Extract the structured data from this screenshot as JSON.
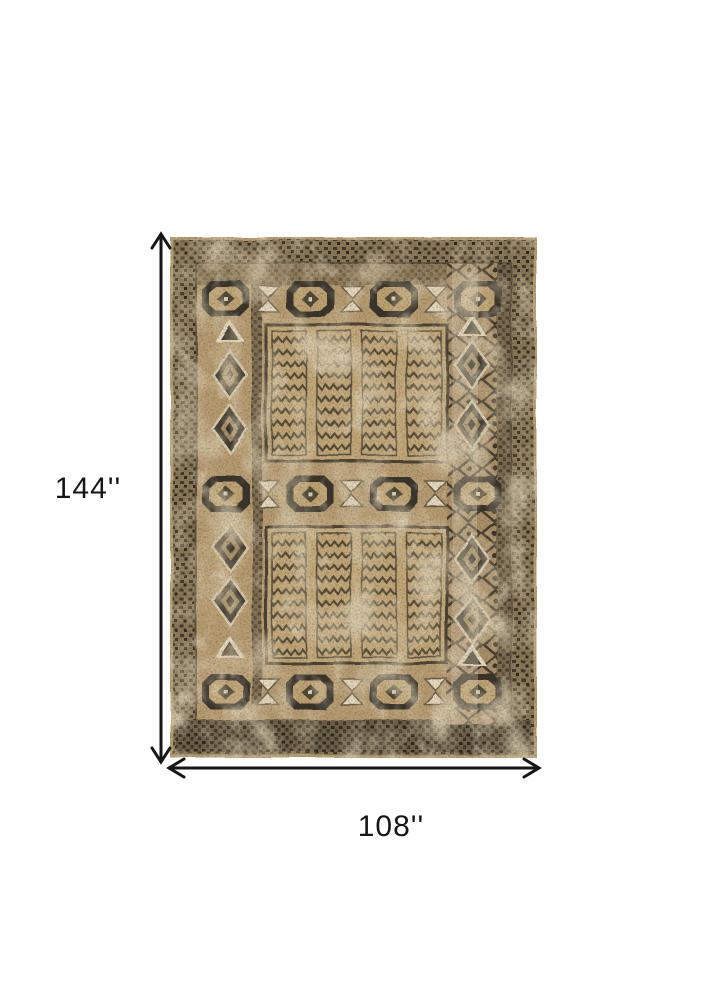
{
  "page": {
    "type": "product-dimension-diagram",
    "background_color": "#ffffff",
    "annotation_color": "#161616"
  },
  "dimensions": {
    "height": {
      "label": "144''",
      "value": 144
    },
    "width": {
      "label": "108''",
      "value": 108
    }
  },
  "rug": {
    "name": "distressed-vintage-oriental-rug",
    "palette": {
      "base_tan": "#b79c71",
      "camel": "#c3a878",
      "light_beige": "#d8caab",
      "cream": "#e8dcc3",
      "dark_charcoal": "#38342c",
      "brown": "#6d5f47"
    }
  }
}
